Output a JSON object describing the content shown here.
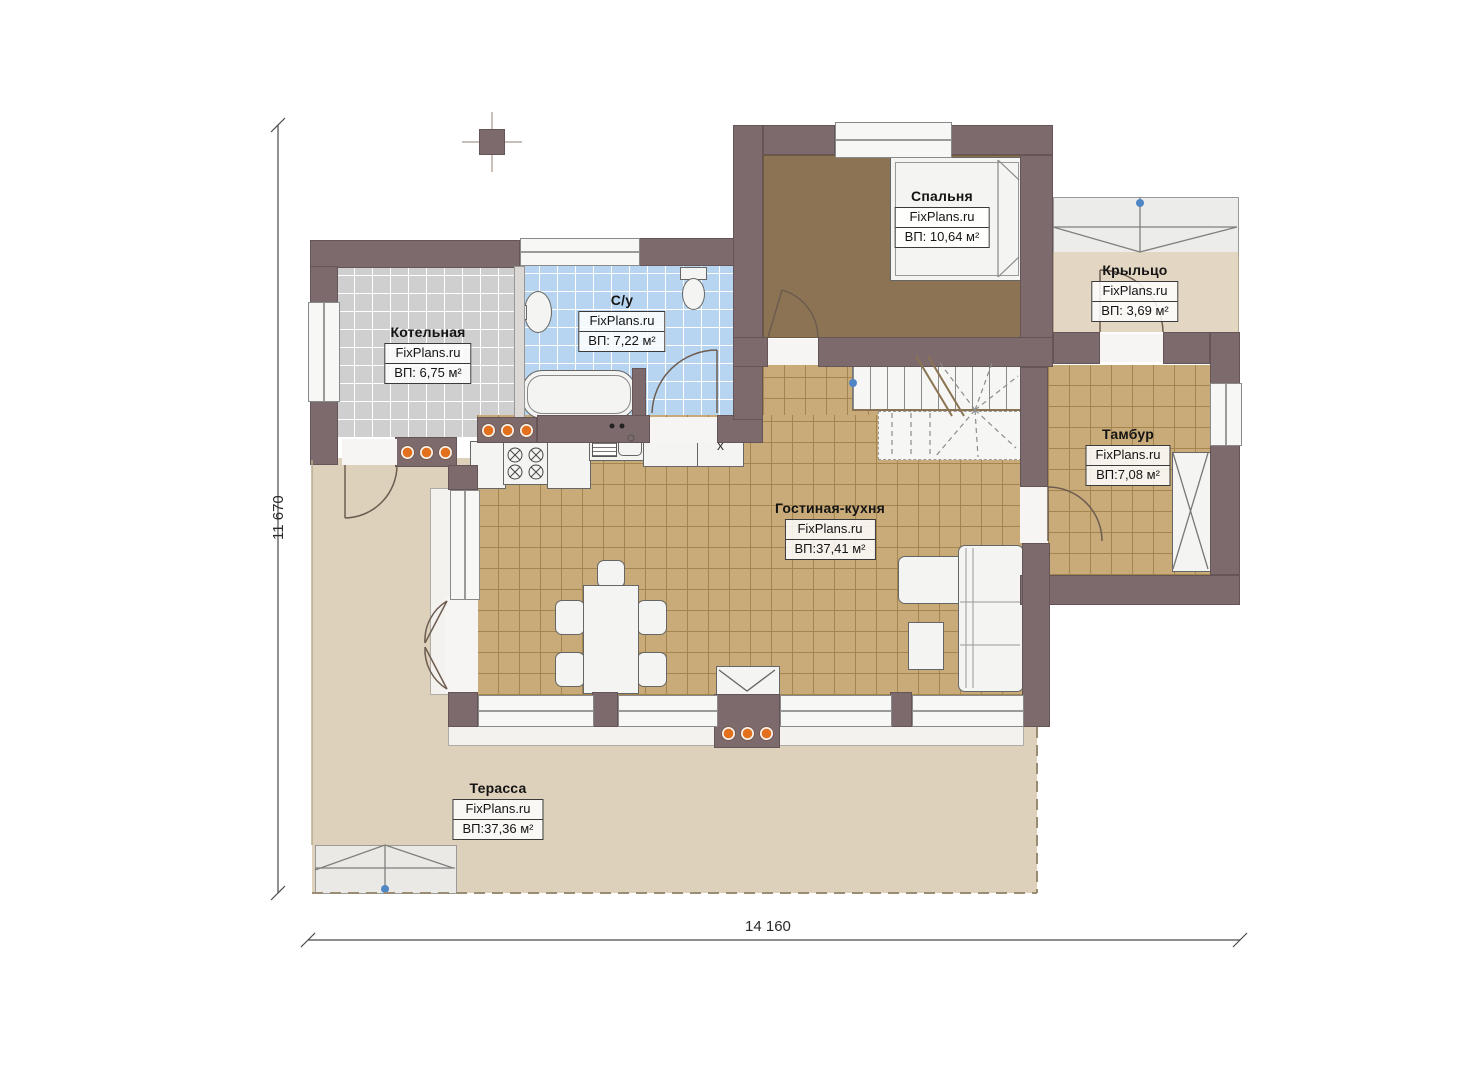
{
  "site_brand": "FixPlans.ru",
  "dimensions": {
    "vertical": "11 670",
    "horizontal": "14 160"
  },
  "rooms": [
    {
      "id": "kotelnaya",
      "name": "Котельная",
      "brand": "FixPlans.ru",
      "area": "ВП: 6,75 м²"
    },
    {
      "id": "su",
      "name": "С/у",
      "brand": "FixPlans.ru",
      "area": "ВП: 7,22 м²"
    },
    {
      "id": "spalnya",
      "name": "Спальня",
      "brand": "FixPlans.ru",
      "area": "ВП: 10,64 м²"
    },
    {
      "id": "kryltso",
      "name": "Крыльцо",
      "brand": "FixPlans.ru",
      "area": "ВП: 3,69 м²"
    },
    {
      "id": "tambur",
      "name": "Тамбур",
      "brand": "FixPlans.ru",
      "area": "ВП:7,08 м²"
    },
    {
      "id": "gostinaya",
      "name": "Гостиная-кухня",
      "brand": "FixPlans.ru",
      "area": "ВП:37,41 м²"
    },
    {
      "id": "terassa",
      "name": "Терасса",
      "brand": "FixPlans.ru",
      "area": "ВП:37,36 м²"
    }
  ],
  "kitchen": {
    "unit_label": "x"
  },
  "fixtures": [
    "bed",
    "bathtub",
    "wash-basin",
    "toilet",
    "stove",
    "kitchen-sink",
    "dining-table",
    "chairs",
    "corner-sofa",
    "coffee-table",
    "wardrobe",
    "stairs",
    "fireplace",
    "porch-steps",
    "terrace-steps",
    "chimney"
  ],
  "colors": {
    "wall": "#7d6a6c",
    "accent_dots": "#e2701c",
    "bath_tile": "#b7d5f1",
    "boiler_tile": "#cfcfcf",
    "living_tile": "#c9aa79",
    "bedroom_floor": "#8c7354",
    "terrace_floor": "#ddd1bc",
    "marker_blue": "#4f86c6"
  }
}
